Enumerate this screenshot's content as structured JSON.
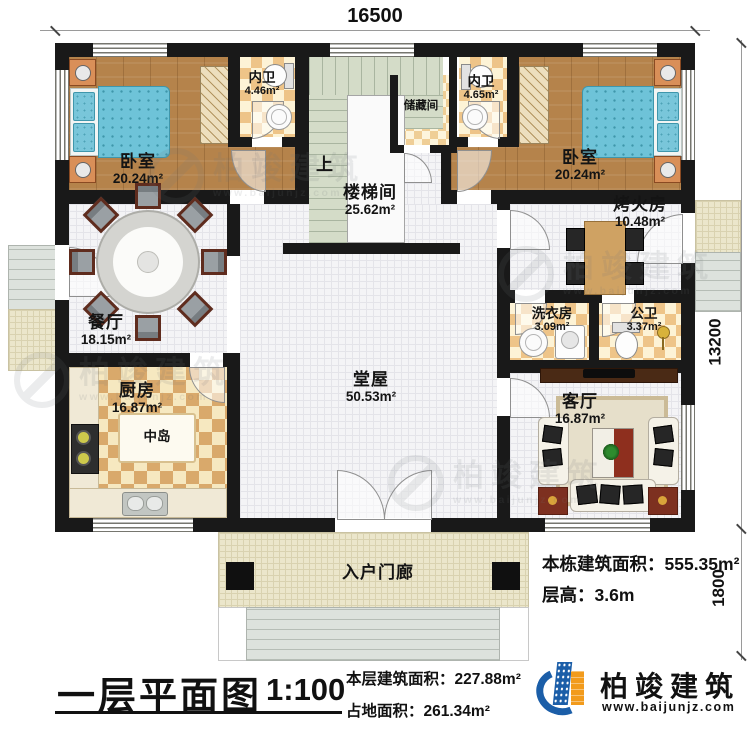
{
  "dimensions": {
    "top": "16500",
    "side": "13200",
    "porch": "1800"
  },
  "rooms": {
    "bedroom_left": {
      "name": "卧室",
      "area": "20.24m²"
    },
    "bath_left": {
      "name": "内卫",
      "area": "4.46m²"
    },
    "storage": {
      "name": "储藏间"
    },
    "bath_right": {
      "name": "内卫",
      "area": "4.65m²"
    },
    "bedroom_right": {
      "name": "卧室",
      "area": "20.24m²"
    },
    "stair": {
      "name": "楼梯间",
      "area": "25.62m²",
      "up": "上"
    },
    "fire_room": {
      "name": "烤火房",
      "area": "10.48m²"
    },
    "dining": {
      "name": "餐厅",
      "area": "18.15m²"
    },
    "laundry": {
      "name": "洗衣房",
      "area": "3.09m²"
    },
    "public_bath": {
      "name": "公卫",
      "area": "3.37m²"
    },
    "kitchen": {
      "name": "厨房",
      "area": "16.87m²",
      "island": "中岛"
    },
    "hall": {
      "name": "堂屋",
      "area": "50.53m²"
    },
    "living": {
      "name": "客厅",
      "area": "16.87m²"
    },
    "porch": {
      "name": "入户门廊"
    }
  },
  "info": {
    "total_area_label": "本栋建筑面积：",
    "total_area_value": "555.35m²",
    "floor_height_label": "层高：",
    "floor_height_value": "3.6m",
    "floor_area_label": "本层建筑面积：",
    "floor_area_value": "227.88m²",
    "footprint_label": "占地面积：",
    "footprint_value": "261.34m²"
  },
  "title": {
    "name": "一层平面图",
    "scale": "1:100"
  },
  "logo": {
    "brand": "柏竣建筑",
    "website": "www.baijunjz.com"
  },
  "colors": {
    "wall": "#191919",
    "wood_floor": "#b5834b",
    "bed": "#6ec3d8",
    "bath_checker": "#eec488",
    "kitchen_checker": "#d9a96b",
    "stair": "#d4dcc8",
    "tile_floor": "#f4f4f6",
    "porch_tile": "#ebe6cb",
    "accent_red": "#7d3020",
    "logo_blue": "#1b5ea8",
    "logo_orange": "#f29b1c"
  }
}
